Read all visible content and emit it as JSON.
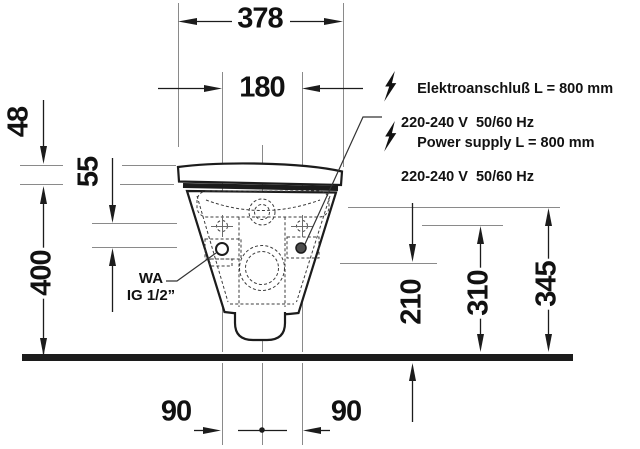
{
  "drawing_title": "wall-hung-toilet-installation-front-view",
  "dimensions_mm": {
    "overall_width": "378",
    "fixing_width": "180",
    "lid_thickness": "48",
    "seat_drop": "55",
    "seat_height": "400",
    "connection_height": "210",
    "outlet_height": "310",
    "supply_height": "345",
    "offset_left": "90",
    "offset_right": "90"
  },
  "annotations": {
    "electro_de": {
      "line1": "Elektroanschluß L = 800 mm",
      "line2": "220-240 V  50/60 Hz"
    },
    "electro_en": {
      "line1": "Power supply L = 800 mm",
      "line2": "220-240 V  50/60 Hz"
    },
    "water_connection": {
      "line1": "WA",
      "line2": "IG 1/2”"
    }
  },
  "icons": {
    "lightning": "lightning-bolt-icon"
  },
  "colors": {
    "outline": "#1c1c1c",
    "thin_line": "#8a8a8a",
    "dashed_line": "#3c3c3c",
    "background": "#ffffff"
  }
}
